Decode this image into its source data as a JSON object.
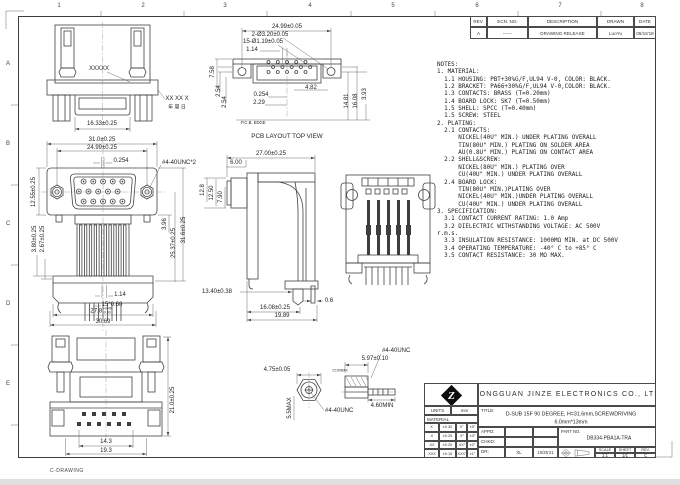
{
  "sheet": {
    "corner_note": "C-DRAWING",
    "grid_cols": [
      "1",
      "2",
      "3",
      "4",
      "5",
      "6",
      "7",
      "8"
    ],
    "grid_rows": [
      "A",
      "B",
      "C",
      "D",
      "E"
    ]
  },
  "rev_table": {
    "headers": [
      "REV.",
      "ECN. NO.",
      "DESCRIPTION",
      "DRAWN",
      "DATE"
    ],
    "rows": [
      [
        "A",
        "------",
        "DRAWING RELEASE",
        "LuoYu",
        "06/16'18"
      ]
    ]
  },
  "notes": {
    "lines": [
      "NOTES:",
      "1. MATERIAL:",
      "  1.1 HOUSING: PBT+30%G/F,UL94 V-0, COLOR: BLACK.",
      "  1.2 BRACKET: PA66+30%G/F,UL94 V-0,COLOR: BLACK.",
      "  1.3 CONTACTS: BRASS (T=0.20mm)",
      "  1.4 BOARD LOCK: SK7 (T=0.50mm)",
      "  1.5 SHELL: SPCC (T=0.40mm)",
      "  1.5 SCREW: STEEL",
      "2. PLATING:",
      "  2.1 CONTACTS:",
      "      NICKEL(40U\" MIN.) UNDER PLATING OVERALL",
      "      TIN(80U\" MIN.) PLATING ON SOLDER AREA",
      "      AU(0.8U\" MIN.) PLATING ON CONTACT AREA",
      "  2.2 SHELL&SCREW:",
      "      NICKEL(80U\" MIN.) PLATING OVER",
      "      CU(40U\" MIN.) UNDER PLATING OVERALL",
      "  2.4 BOARD LOCK:",
      "      TIN(80U\" MIN.)PLATING OVER",
      "      NICKEL(40U\" MIN.)UNDER PLATING OVERALL",
      "      CU(40U\" MIN.) UNDER PLATING OVERALL",
      "3. SPECIFICATION:",
      "  3.1 CONTACT CURRENT RATING: 1.0 Amp",
      "  3.2 DIELECTRIC WITHSTANDING VOLTAGE: AC 500V",
      "r.m.s.",
      "  3.3 INSULATION RESISTANCE: 1000MΩ MIN. at DC 500V",
      "  3.4 OPERATING TEMPERATURE: -40° C to +85° C",
      "  3.5 CONTACT RESISTANCE: 30 MΩ MAX."
    ]
  },
  "views": {
    "bottom_view": {
      "marking": "XXXXX",
      "date_code": "XX XX X",
      "date_code_cn": "年 周 日",
      "dim_width": "16.33±0.25"
    },
    "pcb_view": {
      "caption": "PCB LAYOUT TOP VIEW",
      "pcb_edge": "P.C.B. EDGE",
      "dim_width": "24.99±0.05",
      "dim_holes_large": "2-Ø3.20±0.05",
      "dim_holes_small": "15-Ø1.19±0.05",
      "dim_pitch_half": "1.14",
      "dim_758": "7.58",
      "dim_254a": "2.54",
      "dim_254b": "2.54",
      "dim_482": "4.82",
      "dim_0254": "0.254",
      "dim_229": "2.29",
      "dim_1481": "14.81",
      "dim_1608": "16.08",
      "dim_393": "3.93"
    },
    "front_view": {
      "dim_310": "31.0±0.25",
      "dim_2499": "24.99±0.25",
      "dim_0254": "0.254",
      "label_screw": "#4-40UNC*2",
      "dim_1255": "12.55±0.25",
      "dim_396": "3.96",
      "dim_2537": "25.37±0.25",
      "dim_316": "31.6±0.25",
      "dim_380": "3.80±0.25",
      "dim_267": "2.67±0.25",
      "dim_114": "1.14",
      "dim_pins": "15*0.60",
      "dim_278": "27.8",
      "dim_278_tol_plus": "+0.40",
      "dim_278_tol_minus": "-0.00",
      "dim_3069": "30.69"
    },
    "side_view": {
      "dim_2700": "27.00±0.25",
      "dim_600": "6.00",
      "dim_128": "12.8",
      "dim_1250": "12.50",
      "dim_790": "7.90",
      "dim_1340": "13.40±0.38",
      "dim_1608": "16.08±0.25",
      "dim_1989": "19.89",
      "dim_06": "0.6"
    },
    "top_view": {
      "dim_210": "21.0±0.25",
      "dim_143": "14.3",
      "dim_193": "19.3"
    },
    "screw_view": {
      "dim_475": "4.75±0.05",
      "dim_55max": "5.5MAX",
      "label_unc_a": "#4-40UNC",
      "dim_597": "5.97±0.10",
      "dim_chamfer": "C0.50MAX",
      "dim_460": "4.60MIN",
      "label_unc_b": "#4-40UNC"
    }
  },
  "title_block": {
    "company": "DONGGUAN JINZE ELECTRONICS CO., LTD",
    "title_label": "TITLE:",
    "title_line1": "D-SUB 15F 90 DEGREE, H=31.6mm,SCREWDRIVING",
    "title_line2": "6.0mm*13mm",
    "units_label": "UNITS",
    "units_value": "mm",
    "material_label": "MATERIAL",
    "tolerances": [
      [
        "X",
        "±0.30",
        "X°",
        "±5°"
      ],
      [
        ".X",
        "±0.25",
        ".X°",
        "±3°"
      ],
      [
        ".XX",
        "±0.20",
        ".XX°",
        "±2°"
      ],
      [
        ".XXX",
        "±0.15",
        ".XXX°",
        "±1°"
      ]
    ],
    "appd_label": "APPD:",
    "chkd_label": "CHKD:",
    "dr_label": "DR:",
    "dr_name": "XL",
    "dr_date": "10/25'21",
    "part_no_label": "PART NO.",
    "part_no": "DB334-PBA1A-TRA",
    "scale_label": "SCALE",
    "scale": "1:1",
    "sheet_label": "SHEET",
    "sheet": "1/1",
    "rev_label": "REV.",
    "rev": "C",
    "logo_letter": "Z"
  }
}
